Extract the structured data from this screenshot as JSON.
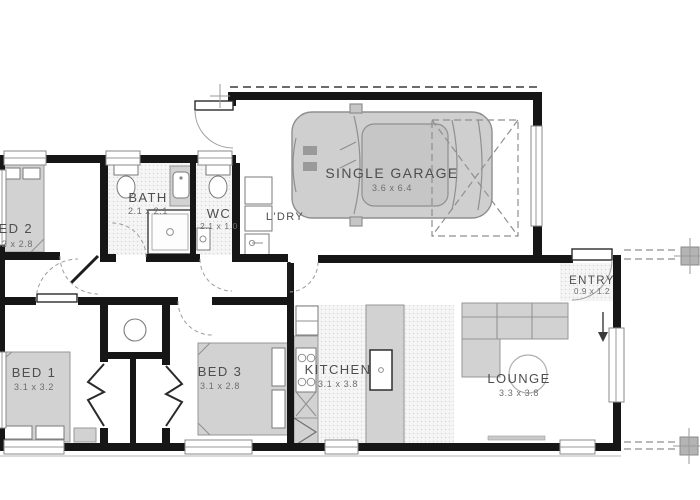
{
  "rooms": {
    "bed1": {
      "name": "BED 1",
      "dims": "3.1 x 3.2"
    },
    "bed2": {
      "name": "BED 2",
      "dims": "3.2 x 2.8"
    },
    "bed3": {
      "name": "BED 3",
      "dims": "3.1 x 2.8"
    },
    "bath": {
      "name": "BATH",
      "dims": "2.1 x 2.1"
    },
    "wc": {
      "name": "WC",
      "dims": "2.1 x 1.0"
    },
    "laundry": {
      "name": "L'DRY"
    },
    "garage": {
      "name": "SINGLE GARAGE",
      "dims": "3.6 x 6.4"
    },
    "entry": {
      "name": "ENTRY",
      "dims": "0.9 x 1.2"
    },
    "kitchen": {
      "name": "KITCHEN",
      "dims": "3.1 x 3.8"
    },
    "lounge": {
      "name": "LOUNGE",
      "dims": "3.3 x 3.8"
    }
  },
  "colors": {
    "wall": "#161616",
    "furniture": "#d2d2d2",
    "floor_dot": "#d8d8d8",
    "outline": "#8f8f8f"
  }
}
